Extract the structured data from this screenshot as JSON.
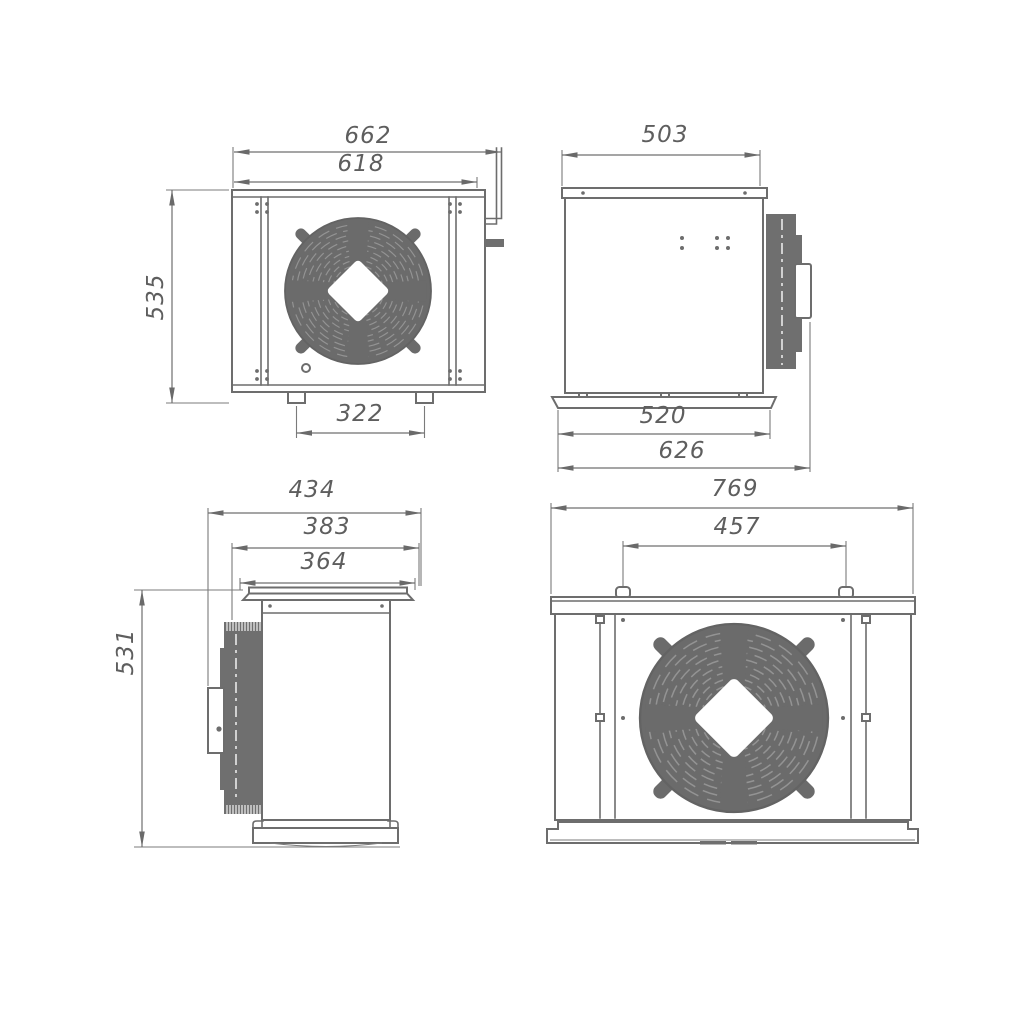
{
  "document": {
    "type": "engineering-drawing",
    "subject": "fan condensing unit - four orthographic dimensioned views",
    "background": "#ffffff",
    "line_color": "#6d6d6d",
    "fill_color": "#6f6f6f",
    "fan_fill_color": "#6b6b6b",
    "dim_text_color": "#5e5e5e"
  },
  "views": {
    "front": {
      "label": "front view (fan side)",
      "dims": {
        "overall_width": "662",
        "body_width": "618",
        "overall_height": "535",
        "feet_spacing": "322"
      }
    },
    "side_right": {
      "label": "side view with condenser coil",
      "dims": {
        "top_depth": "503",
        "base_depth": "520",
        "overall_depth": "626"
      }
    },
    "side_left": {
      "label": "side view with coil and junction box",
      "dims": {
        "overall_depth": "434",
        "mid_depth": "383",
        "flange_width": "364",
        "overall_height": "531"
      }
    },
    "rear": {
      "label": "rear view (grille side)",
      "dims": {
        "overall_width": "769",
        "hanger_spacing": "457"
      }
    }
  }
}
